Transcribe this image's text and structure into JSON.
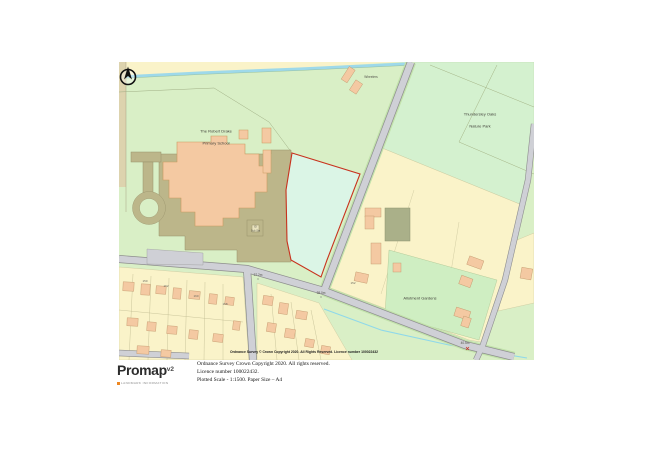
{
  "map": {
    "school_name_line1": "The Robert Drake",
    "school_name_line2": "Primary School",
    "wheelers_label": "Wheelers",
    "nature_park_line1": "Thundersley Oaks",
    "nature_park_line2": "Nature Park",
    "allotment_label": "Allotment Gardens",
    "substation_line1": "El",
    "substation_line2": "Sub Sta",
    "spot_heights": [
      "37.2m",
      "38.0m",
      "40.5m"
    ],
    "house_numbers": [
      "162",
      "160",
      "158",
      "152",
      "150"
    ],
    "watermark": "Ordnance Survey © Crown Copyright 2020. All Rights Reserved. Licence number 100022432",
    "colors": {
      "plot_boundary": "#c8321e",
      "grass_green": "#d9efc6",
      "park_green": "#d4f1cf",
      "plot_green": "#dbf5e6",
      "parcel_yellow": "#faf3c9",
      "building_peach": "#f4c9a2",
      "hardstanding_khaki": "#bcb68a",
      "road_grey": "#cfd0d6",
      "water_blue": "#9ed9ea"
    }
  },
  "footer": {
    "logo_text": "Promap",
    "logo_version": "v2",
    "logo_tagline": "LANDMARK INFORMATION",
    "copyright_line1": "Ordnance Survey Crown Copyright 2020. All rights reserved.",
    "copyright_line2": "Licence number 100022432.",
    "copyright_line3": "Plotted Scale - 1:1500. Paper Size – A4"
  }
}
